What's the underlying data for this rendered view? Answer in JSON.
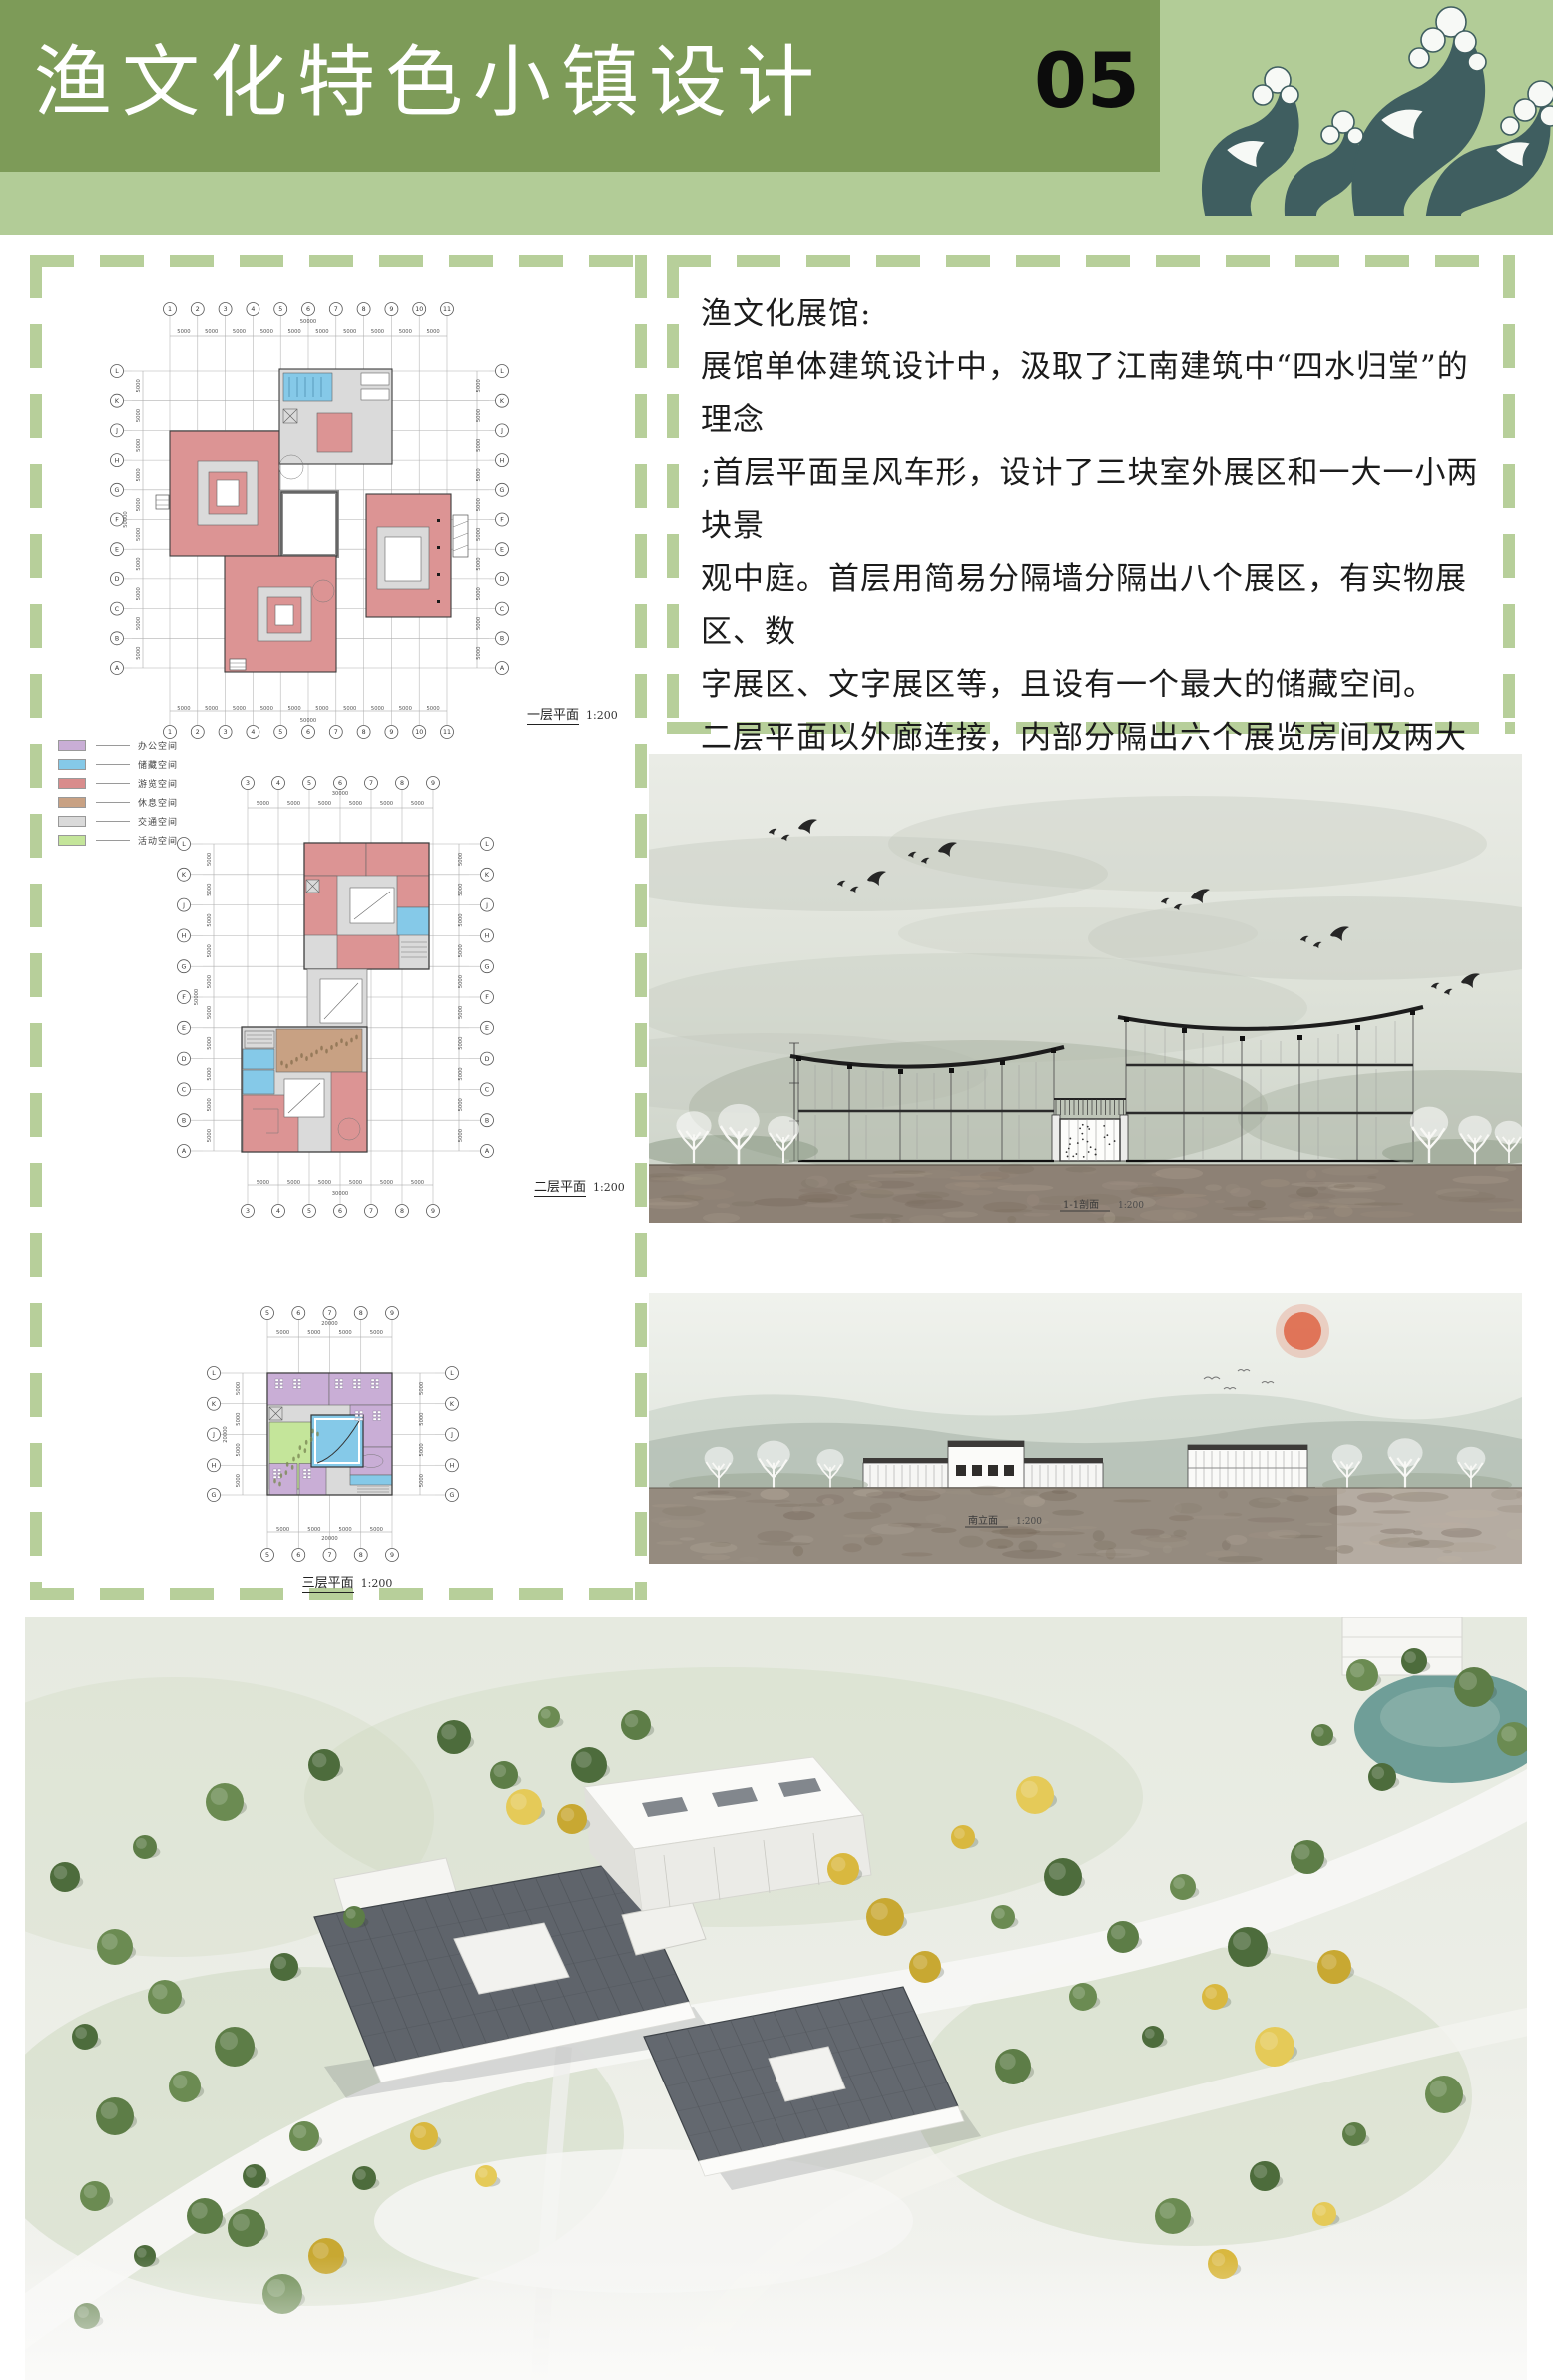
{
  "header": {
    "title": "渔文化特色小镇设计",
    "page_number": "05"
  },
  "colors": {
    "header_dark_green": "#7d9b58",
    "header_light_green": "#b2cc97",
    "dash_green": "#b7cf9a",
    "wave_teal": "#3f5e60",
    "plan_pink": "#dc9494",
    "plan_blue": "#85c9e8",
    "plan_purple": "#c9aed6",
    "plan_tan": "#c8a183",
    "plan_grey": "#dadada",
    "plan_green": "#c4e59a",
    "ground_brown": "#8d8175",
    "sun_orange": "#df6a4c",
    "pond_teal": "#6f9e98",
    "roof_grey": "#5f646b",
    "tree_green": "#5d7d47",
    "tree_yellow": "#ddbb45"
  },
  "text_panel": {
    "heading": "渔文化展馆:",
    "lines": [
      "展馆单体建筑设计中，汲取了江南建筑中“四水归堂”的理念",
      ";首层平面呈风车形，设计了三块室外展区和一大一小两块景",
      "观中庭。首层用简易分隔墙分隔出八个展区，有实物展区、数",
      "字展区、文字展区等，且设有一个最大的储藏空间。",
      "二层平面以外廊连接，内部分隔出六个展览房间及两大一小三",
      "个储藏空间。",
      "三层平面为正方形，其功能主要为办公。"
    ]
  },
  "legend": {
    "items": [
      {
        "label": "办公空间",
        "color": "#c9aed6"
      },
      {
        "label": "储藏空间",
        "color": "#85c9e8"
      },
      {
        "label": "游览空间",
        "color": "#d98c8c"
      },
      {
        "label": "休息空间",
        "color": "#c8a183"
      },
      {
        "label": "交通空间",
        "color": "#dadada"
      },
      {
        "label": "活动空间",
        "color": "#c4e59a"
      }
    ]
  },
  "plans": [
    {
      "name": "一层平面",
      "scale": "1:200",
      "bay_dim": "5000",
      "col_total": "50000",
      "row_total": "50000",
      "grid_cols": [
        "1",
        "2",
        "3",
        "4",
        "5",
        "6",
        "7",
        "8",
        "9",
        "10",
        "11"
      ],
      "grid_rows": [
        "L",
        "K",
        "J",
        "H",
        "G",
        "F",
        "E",
        "D",
        "C",
        "B",
        "A"
      ]
    },
    {
      "name": "二层平面",
      "scale": "1:200",
      "bay_dim": "5000",
      "col_total": "30000",
      "row_total": "50000",
      "grid_cols": [
        "3",
        "4",
        "5",
        "6",
        "7",
        "8",
        "9"
      ],
      "grid_rows": [
        "L",
        "K",
        "J",
        "H",
        "G",
        "F",
        "E",
        "D",
        "C",
        "B",
        "A"
      ]
    },
    {
      "name": "三层平面",
      "scale": "1:200",
      "bay_dim": "5000",
      "col_total": "20000",
      "row_total": "20000",
      "grid_cols": [
        "5",
        "6",
        "7",
        "8",
        "9"
      ],
      "grid_rows": [
        "L",
        "K",
        "J",
        "H",
        "G"
      ]
    }
  ],
  "sections": [
    {
      "label": "1-1剖面",
      "scale": "1:200"
    },
    {
      "label": "南立面",
      "scale": "1:200"
    }
  ]
}
